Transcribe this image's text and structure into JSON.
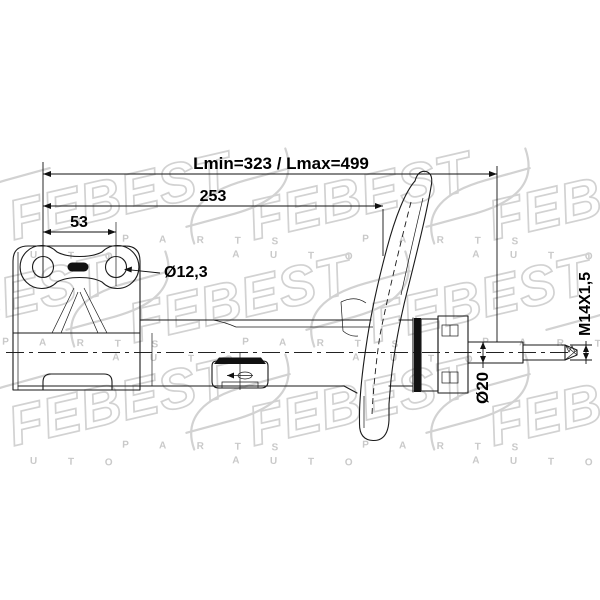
{
  "page": {
    "background": "#ffffff"
  },
  "drawing": {
    "type": "technical-diagram",
    "subject": "front suspension shock absorber strut, side view",
    "line_color": "#1a1a1a",
    "dimensions": {
      "overall_length": "Lmin=323 / Lmax=499",
      "body_length": "253",
      "hole_spacing": "53",
      "hole_diameter": "Ø12,3",
      "rod_diameter": "Ø20",
      "thread_spec": "M14X1,5"
    }
  },
  "watermark": {
    "logo_text": "FEBEST",
    "auto_spaced": "A U T O",
    "parts_spaced": "P A R T S",
    "color": "#d2d2d2"
  }
}
